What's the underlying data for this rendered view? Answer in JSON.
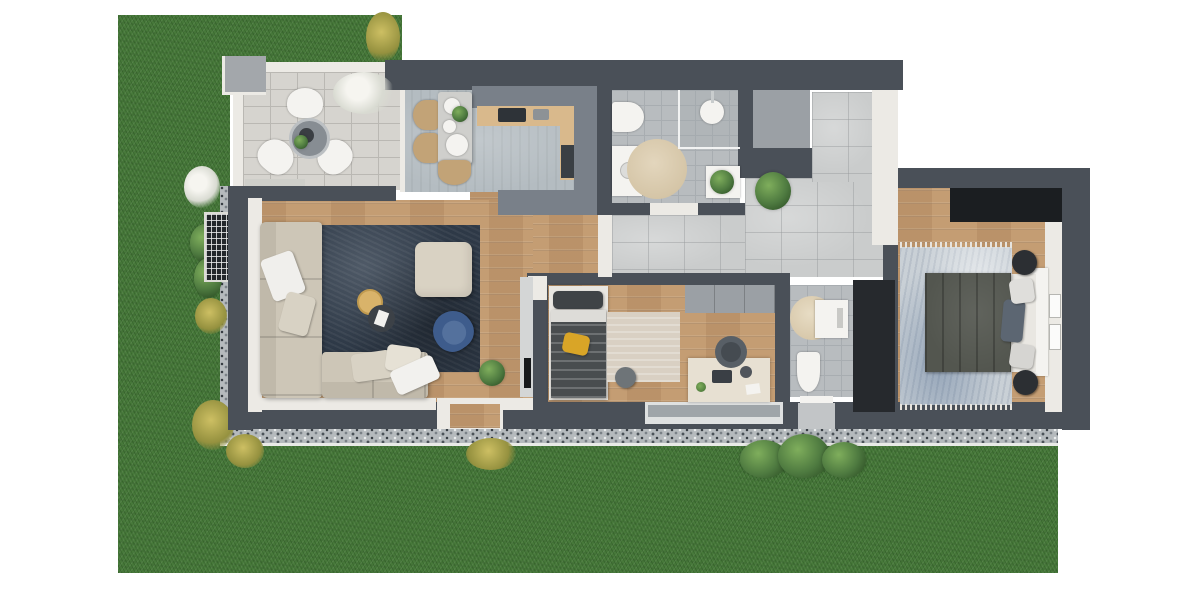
{
  "scene": {
    "kind": "3d-rendered-apartment-floor-plan-top-view",
    "garden": {
      "lawn": "green grass wrapping left side and bottom",
      "border": "gravel drainage strip along facade",
      "plants": [
        "white flower shrub",
        "green bushes",
        "yellow grass tufts",
        "large shrub at bottom",
        "tall plant at top edge"
      ],
      "basement_window": "grated light well on left lawn"
    },
    "rooms": [
      {
        "name": "terrace",
        "floor": "stone pavers",
        "furniture": [
          "round bistro table",
          "three white chairs",
          "white flowering bush",
          "corner pillar"
        ]
      },
      {
        "name": "kitchen-dining",
        "floor": "grey tile",
        "furniture": [
          "L-shaped counter",
          "cooktop",
          "dark lower cabinet",
          "dining table with plates and plant",
          "three rattan chairs",
          "low sideboard"
        ]
      },
      {
        "name": "bathroom",
        "floor": "grey tile",
        "furniture": [
          "toilet",
          "vanity",
          "walk-in shower",
          "round beige rug",
          "cabinet with plant"
        ]
      },
      {
        "name": "hallway",
        "floor": "concrete tile",
        "furniture": [
          "potted plant"
        ],
        "extras": [
          "utility shaft",
          "open door to bedroom",
          "entry pad outside"
        ]
      },
      {
        "name": "living-room",
        "floor": "wood plank",
        "furniture": [
          "corner sofa with pillows",
          "beige ottoman",
          "gold side table",
          "dark coffee table with book",
          "navy armchair",
          "dark navy rug",
          "tv sideboard",
          "floor plant",
          "terrace sliding door",
          "garden door with wood step"
        ]
      },
      {
        "name": "kids-room",
        "floor": "wood plank",
        "furniture": [
          "single bed with yellow cushion",
          "beige rug",
          "grey pouf",
          "desk with laptop",
          "office chair",
          "wall closet",
          "large bottom window"
        ]
      },
      {
        "name": "wc",
        "floor": "grey tile",
        "furniture": [
          "toilet",
          "washbasin cabinet",
          "round beige rug"
        ]
      },
      {
        "name": "storage",
        "floor": "dark",
        "furniture": []
      },
      {
        "name": "bedroom",
        "floor": "wood plank",
        "furniture": [
          "double bed with headboard and pillows",
          "black wardrobe",
          "two round nightstands",
          "light mottled rug with fringe",
          "two wall frames"
        ]
      }
    ]
  },
  "palette": {
    "grass": "#47793a",
    "gravel_base": "#b5babd",
    "gravel_dark": "#343a40",
    "wall_dark": "#4a5058",
    "trim_white": "#eceae5",
    "paver": "#d6d4cf",
    "paver_line": "#bab8b3",
    "wood": "#c49d73",
    "tile_bath": "#b8bcbf",
    "tile_line": "#a8adb1",
    "tile_hall": "#cacccc",
    "kitchen_floor": "#b4bcc1",
    "counter_grey": "#798089",
    "counter_wood": "#d9b98c",
    "rug_navy": "#2e3947",
    "rug_light": "#c9d0d6",
    "sofa": "#cdc6b7",
    "sofa_dark": "#c0b9aa",
    "ottoman": "#d9d2c3",
    "armchair_blue": "#3e5c8c",
    "bed_duvet": "#53564f",
    "kids_duvet": "#494d4f",
    "accent_yellow": "#d9a527",
    "wardrobe_black": "#1b1e21",
    "storage_black": "#26292d",
    "plant_green": "#4e7a40",
    "fixture_white": "#f4f3f0",
    "shaft_grey": "#9ba0a5",
    "gold_table": "#d9b36a",
    "table_dark": "#3c4147"
  }
}
